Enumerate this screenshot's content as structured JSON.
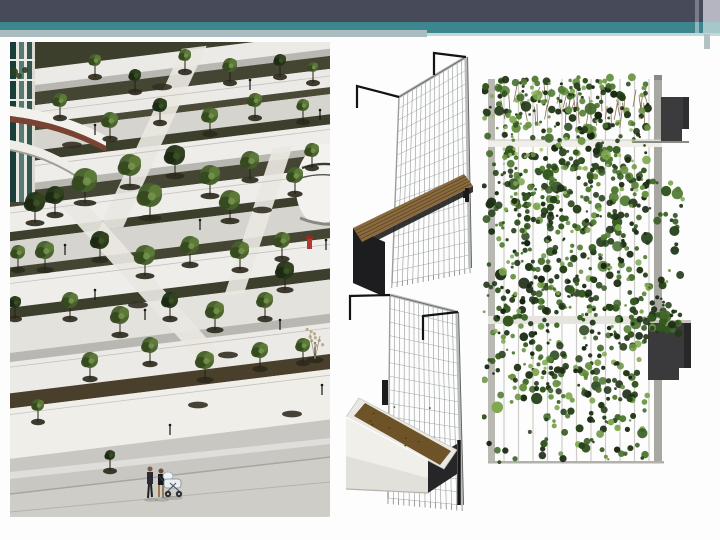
{
  "slide": {
    "background": "#fdfdfd",
    "theme": {
      "header_dark": "#474a59",
      "header_teal": "#3e868e",
      "header_accent_gray": "#a9bcc0",
      "edge_light_lavender": "#b4b5c1",
      "edge_light_teal": "#a6c8cb"
    },
    "figures": [
      {
        "id": "plaza-aerial-photo",
        "alt": "Aerial photograph of a terraced public plaza with scattered young trees in circular planting pits, zig-zag white paths, a curved balcony building on the left and two pedestrians pushing a white pram at the bottom"
      },
      {
        "id": "trellis-planter-render-top",
        "alt": "3D rendering of a wire-mesh trellis panel hung from two black hooks with a dark planter box with wooden top mounted across it"
      },
      {
        "id": "trellis-planter-render-bottom",
        "alt": "3D rendering of a wire-mesh trellis panel hung from two black hooks with a white-fronted planter box filled with soil"
      },
      {
        "id": "green-facade-elevation",
        "alt": "Elevation view of a climbing-plant green facade on vertical cables between two posts with two dark balcony planter boxes projecting on the right"
      }
    ]
  }
}
